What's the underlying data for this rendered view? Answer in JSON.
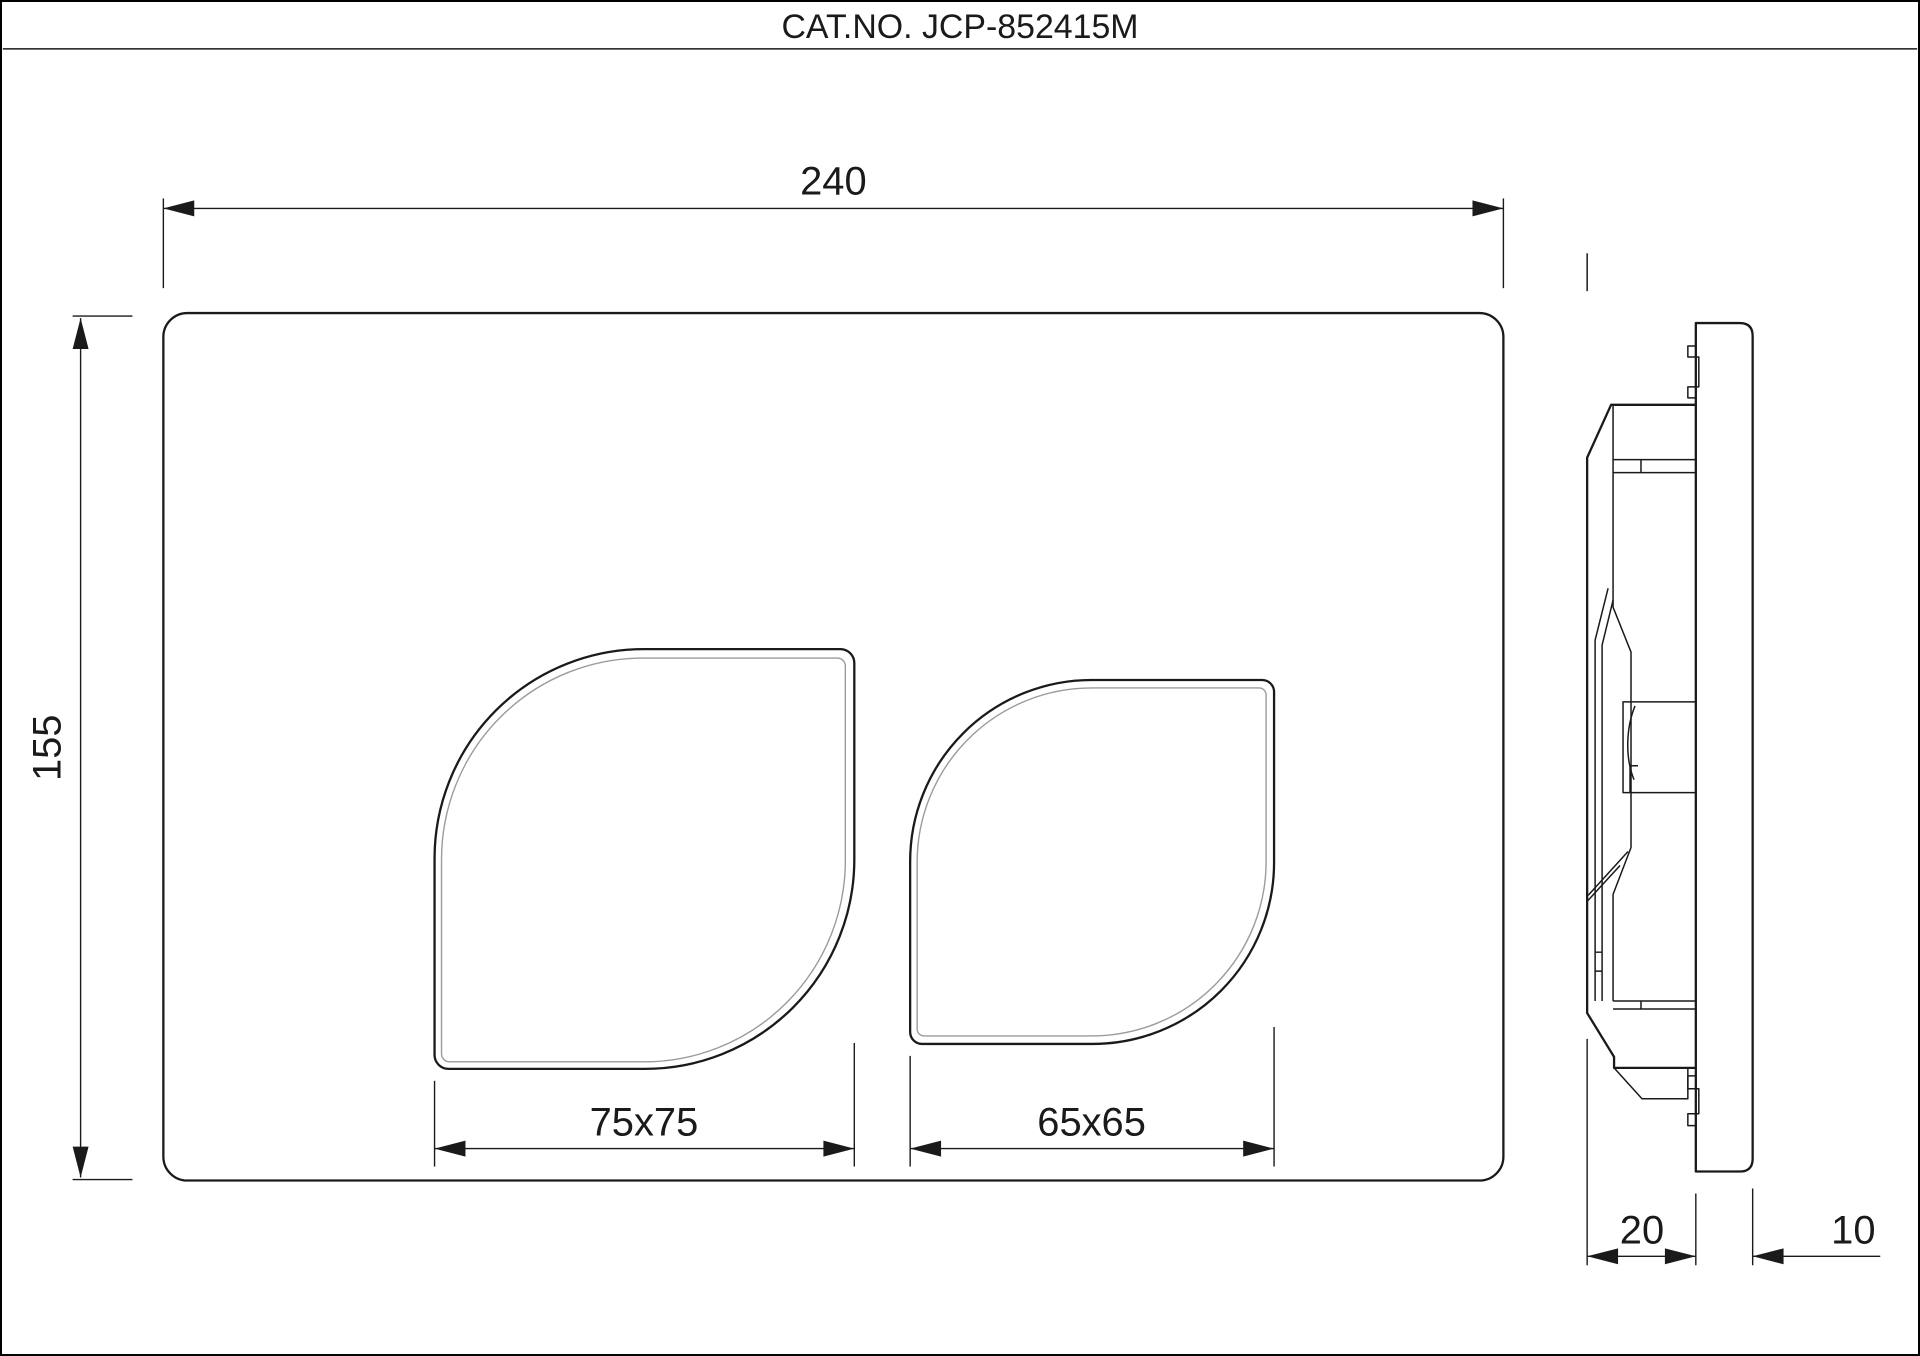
{
  "sheet": {
    "title": "CAT.NO. JCP-852415M"
  },
  "front_view": {
    "description-of-view": "front view of rectangular flush plate with two leaf-shaped buttons",
    "dim_width": "240",
    "dim_height": "155",
    "dim_button_large": "75x75",
    "dim_button_small": "65x65"
  },
  "side_view": {
    "description-of-view": "side profile of plate with mounting mechanism",
    "dim_mechanism_depth": "20",
    "dim_plate_thickness": "10"
  },
  "colors": {
    "line": "#1a1a1a",
    "inner_line": "#9b9b9b",
    "bg": "#ffffff",
    "border": "#000000"
  }
}
